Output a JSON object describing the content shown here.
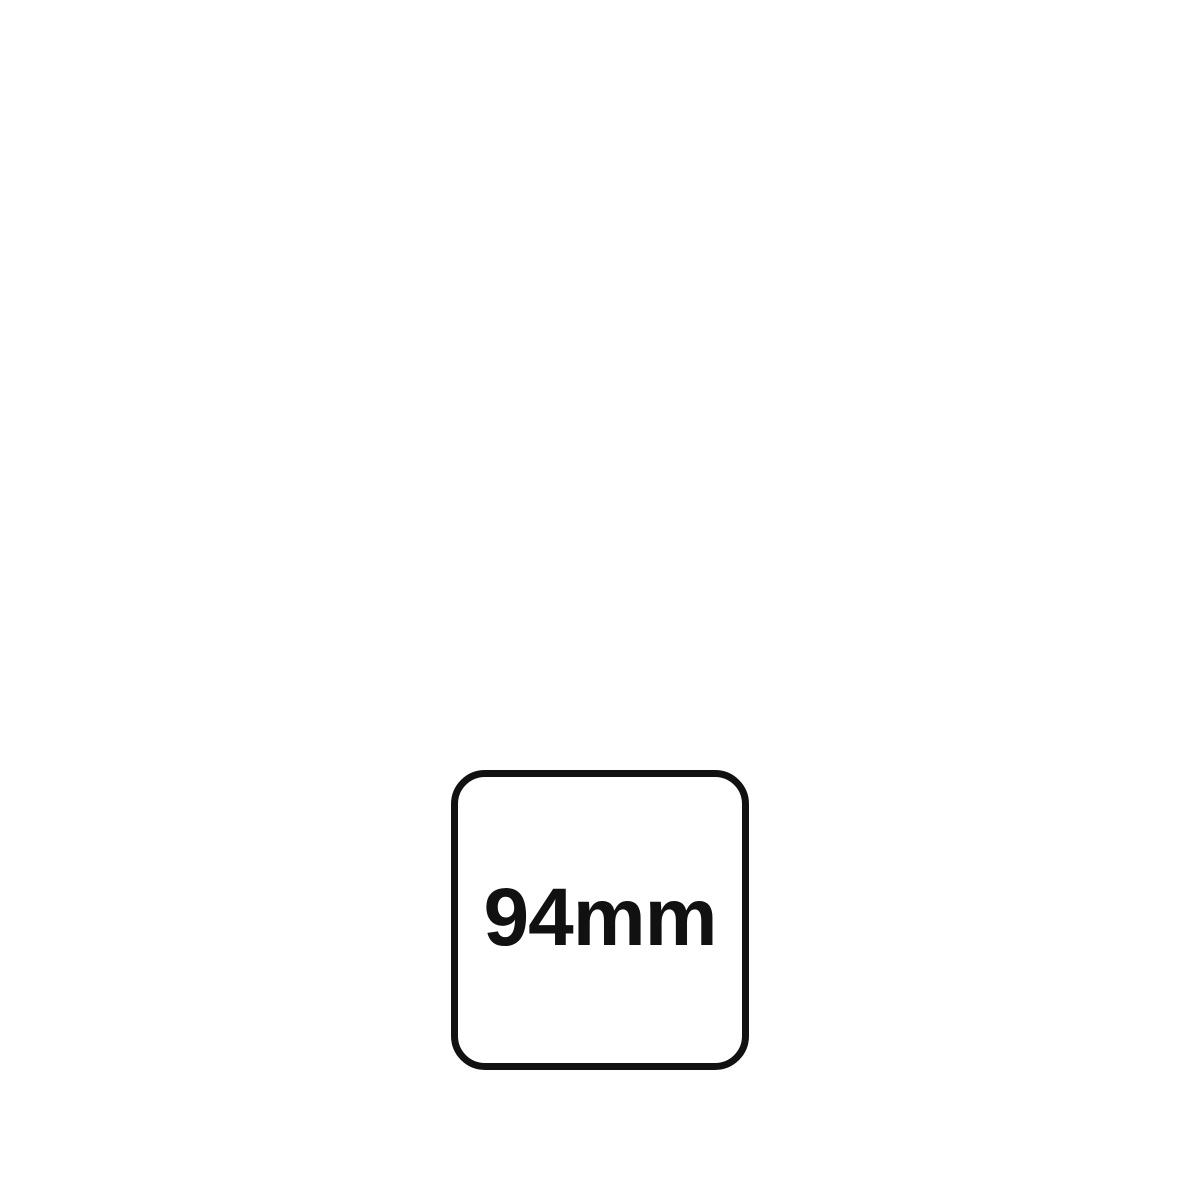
{
  "badge": {
    "label": "94mm",
    "meaning": "dimension-size-indicator",
    "shape": "rounded-square-outline",
    "colors": {
      "stroke": "#111111",
      "text": "#111111",
      "background": "#ffffff",
      "page_background": "#ffffff"
    }
  }
}
